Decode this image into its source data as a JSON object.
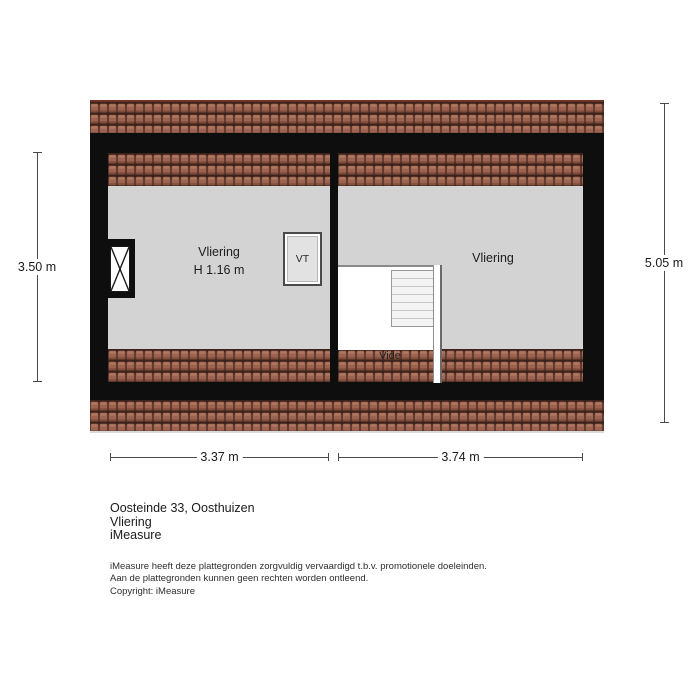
{
  "floorplan": {
    "left_room": {
      "name": "Vliering",
      "height": "H 1.16 m"
    },
    "right_room": {
      "name": "Vliering"
    },
    "vide_label": "Vide",
    "vt_label": "VT",
    "dimensions": {
      "left_height": "3.50 m",
      "right_height": "5.05 m",
      "bottom_left_width": "3.37 m",
      "bottom_right_width": "3.74 m"
    },
    "colors": {
      "roof_tile": "#9c6350",
      "roof_tile_dark": "#3c221a",
      "wall": "#0e0e0e",
      "floor": "#d3d3d3"
    }
  },
  "footer": {
    "address": "Oosteinde 33, Oosthuizen",
    "floor_name": "Vliering",
    "brand": "iMeasure",
    "disclaimer": [
      "iMeasure heeft deze plattegronden zorgvuldig vervaardigd t.b.v. promotionele doeleinden.",
      "Aan de plattegronden kunnen geen rechten worden ontleend.",
      "Copyright: iMeasure"
    ]
  }
}
